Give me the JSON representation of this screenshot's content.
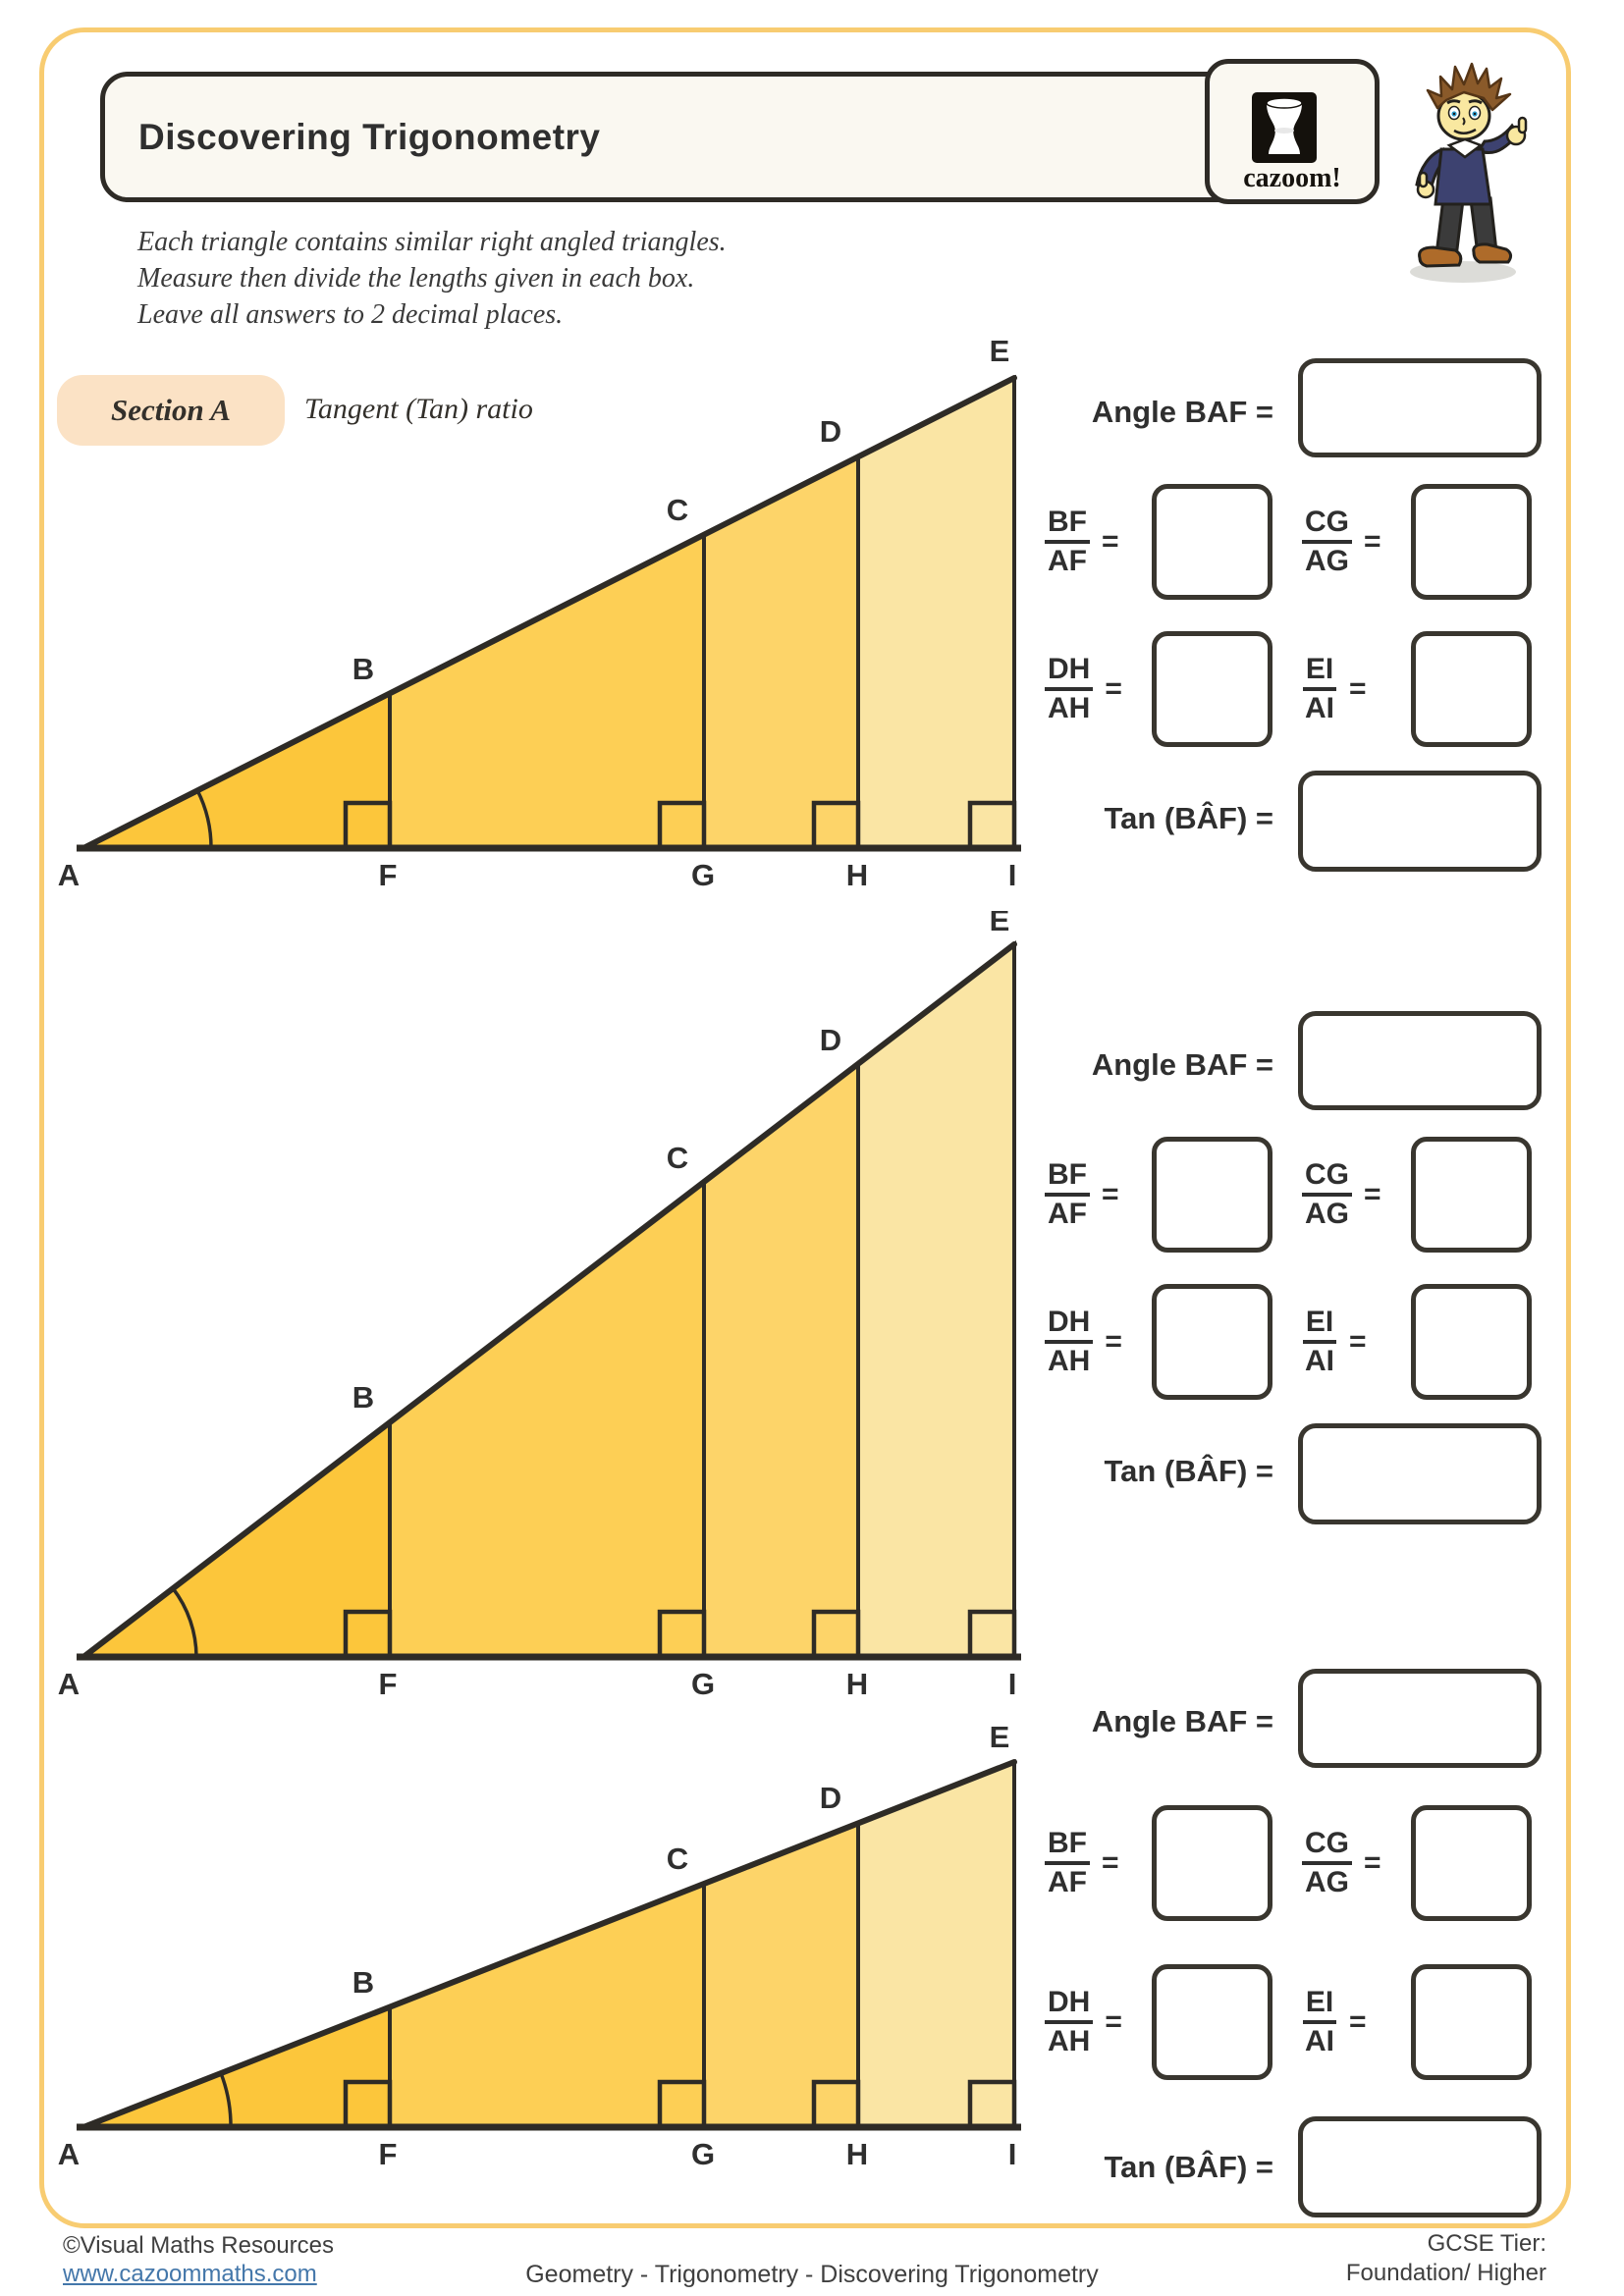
{
  "colors": {
    "band1": "#FCC63B",
    "band2": "#FDCF55",
    "band3": "#FDD469",
    "band4": "#FAE5A4",
    "outline": "#2E2B26",
    "text": "#2F2F2F",
    "page-border": "#F8CC71",
    "badge-bg": "#FBE2C5",
    "header-bg": "#FAF8F1",
    "link": "#4477AA",
    "hair": "#8A5A2A",
    "sweater": "#3D4270",
    "skin": "#F9E8A0",
    "pants": "#3B3B3B",
    "shoe": "#AE6B2A"
  },
  "header": {
    "title": "Discovering Trigonometry",
    "logo_text": "cazoom!"
  },
  "instructions": {
    "line1": "Each triangle contains similar right angled triangles.",
    "line2": "Measure then divide the lengths given in each box.",
    "line3": "Leave all answers to 2 decimal places."
  },
  "section": {
    "label": "Section A",
    "subtitle": "Tangent (Tan) ratio"
  },
  "triangle": {
    "vertices": {
      "A": "A",
      "B": "B",
      "C": "C",
      "D": "D",
      "E": "E",
      "F": "F",
      "G": "G",
      "H": "H",
      "I": "I"
    }
  },
  "panel": {
    "angle_label": "Angle BAF =",
    "tan_label": "Tan (BÂF) =",
    "equals": "=",
    "frac1": {
      "num": "BF",
      "den": "AF"
    },
    "frac2": {
      "num": "CG",
      "den": "AG"
    },
    "frac3": {
      "num": "DH",
      "den": "AH"
    },
    "frac4": {
      "num": "EI",
      "den": "AI"
    }
  },
  "footer": {
    "copyright": "©Visual Maths Resources",
    "url": "www.cazoommaths.com",
    "center": "Geometry - Trigonometry - Discovering Trigonometry",
    "tier_label": "GCSE Tier:",
    "tier_value": "Foundation/ Higher"
  }
}
